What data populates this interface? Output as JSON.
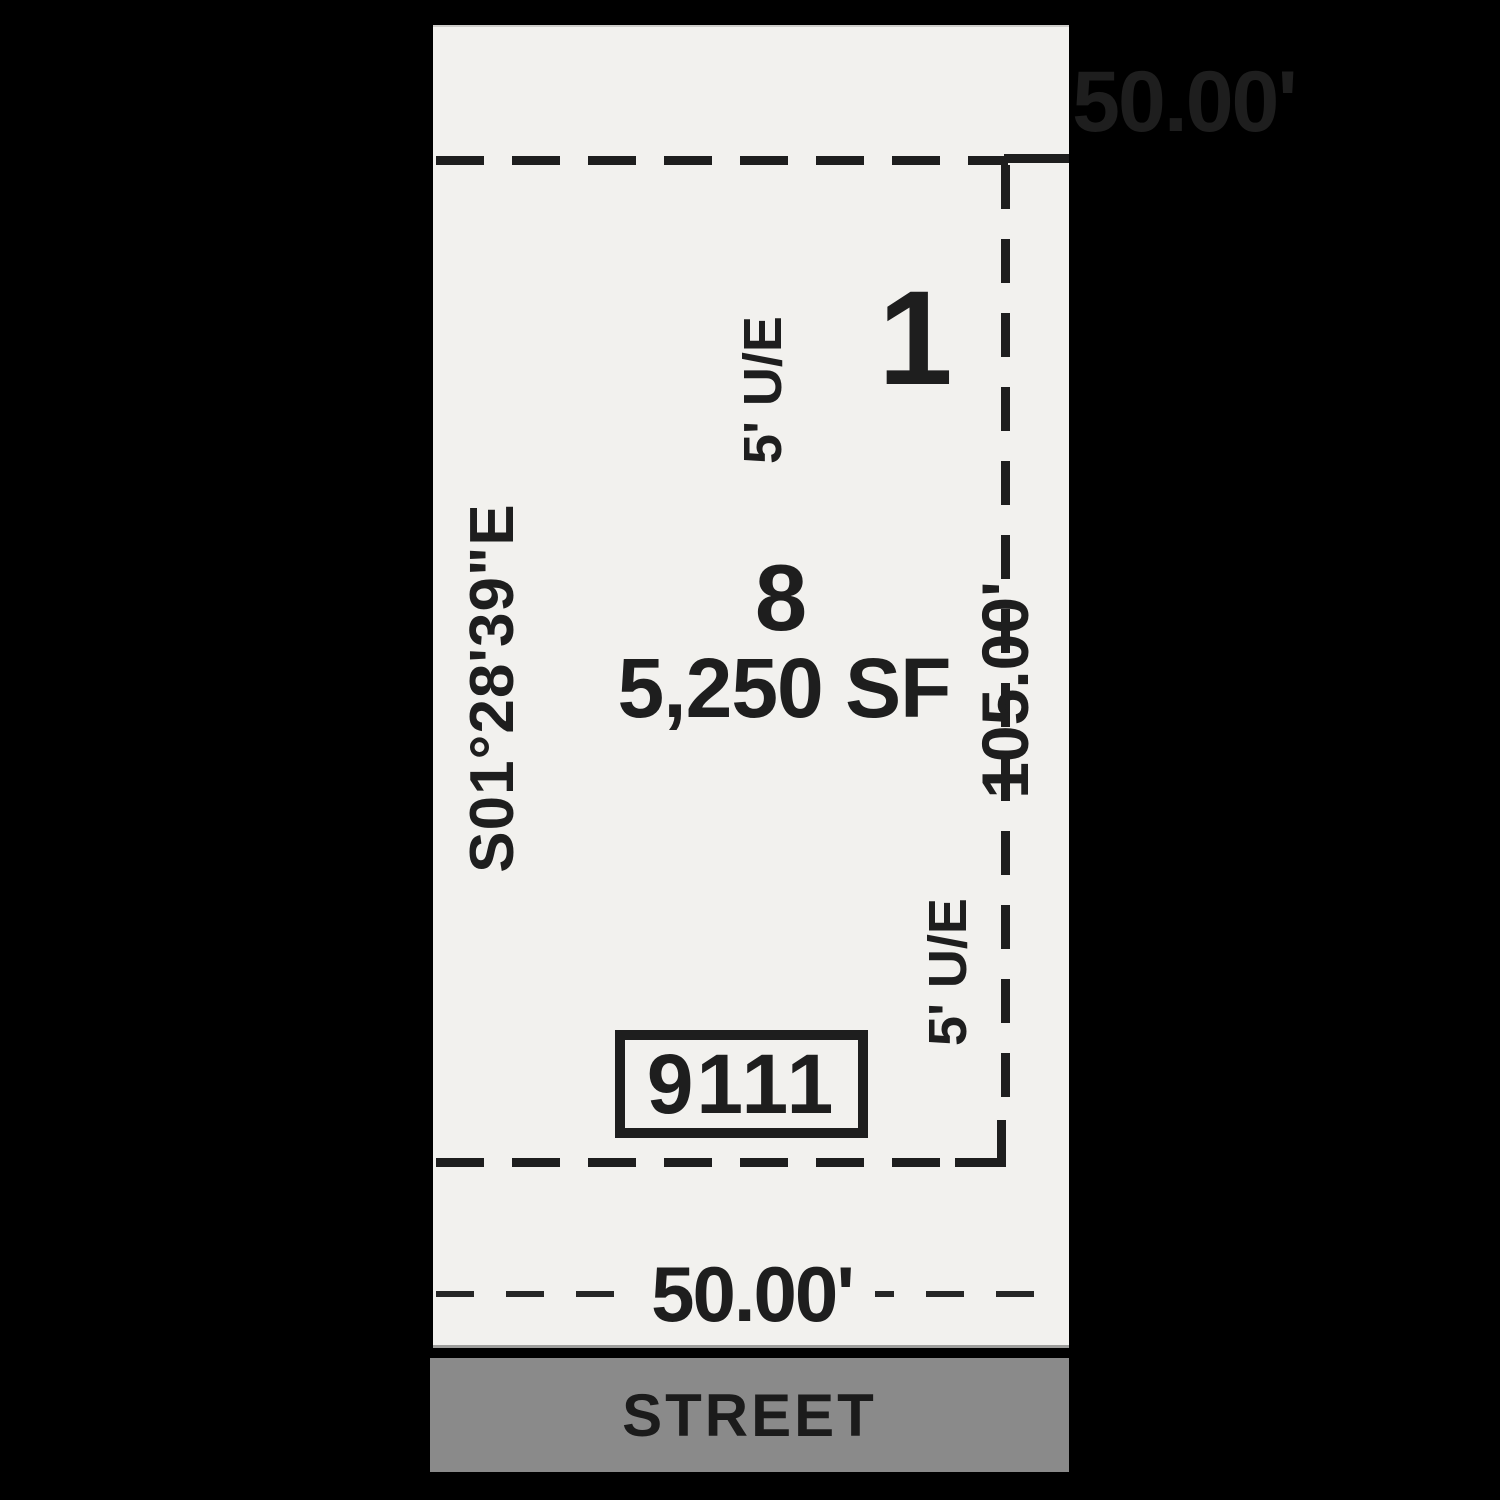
{
  "plat": {
    "lot_number": "8",
    "lot_area": "5,250 SF",
    "address": "9111",
    "adjacent_lot_number": "1",
    "bearing_west": "S01°28'39\"E",
    "dimension_north": "50.00'",
    "dimension_south": "50.00'",
    "dimension_east": "105.00'",
    "easement_label_north": "5' U/E",
    "easement_label_south": "5' U/E",
    "street_label": "STREET"
  },
  "colors": {
    "background": "#000000",
    "paper": "#f2f1ee",
    "ink": "#1e1e1e",
    "street_band": "#8a8a8a",
    "street_text": "#1b1b1b"
  }
}
